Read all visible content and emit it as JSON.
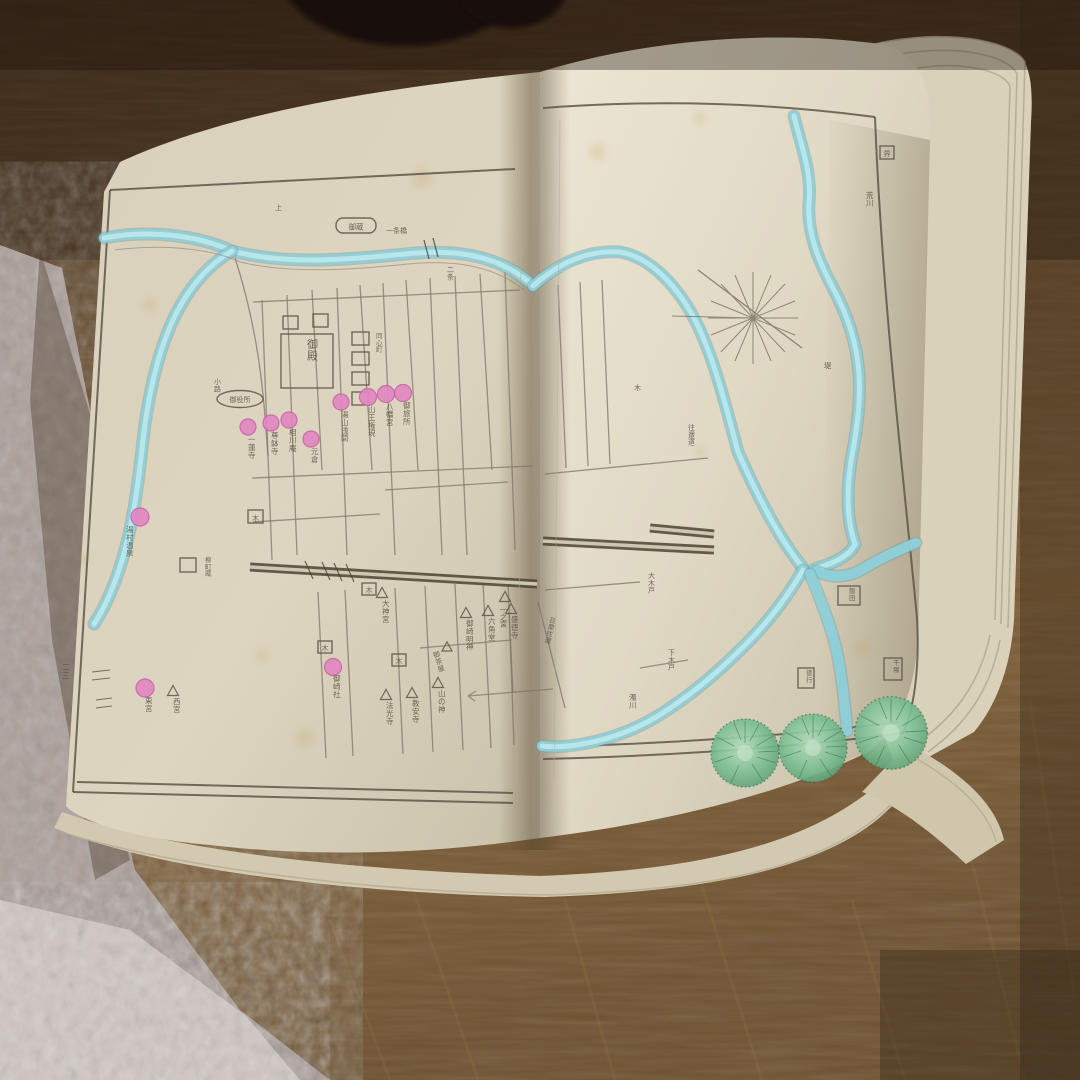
{
  "colors": {
    "wood_dark": "#4a3521",
    "wood_mid": "#6b4e2c",
    "wood_light": "#84633b",
    "carpet": "#b3a7a1",
    "carpet_light": "#d8d0ca",
    "page_cream": "#ded6c0",
    "page_shadow": "#c3bba4",
    "river_blue": "#8fd0d9",
    "marker_pink": "#e387c3",
    "tree_green": "#7cbf92",
    "ink": "#564e3e",
    "black_object": "#16100b"
  },
  "left_page": {
    "palace_label": "御殿",
    "storehouse_cartouche": "御蔵",
    "office_cartouche": "御役所",
    "barracks_label": "同心町",
    "bridge_label": "一条橋",
    "bridge_label_2": "二条",
    "top_margin_char": "上",
    "lane_label": "小路",
    "storehouse_label": "柳町蔵",
    "page_number": "二三",
    "gates": [
      "木",
      "木",
      "木",
      "木"
    ],
    "shrines": [
      {
        "label": "一蓮寺"
      },
      {
        "label": "尊躰寺"
      },
      {
        "label": "相川庵"
      },
      {
        "label": "元倉"
      },
      {
        "label": "湯山浅間"
      },
      {
        "label": "山王権現"
      },
      {
        "label": "八幡宮"
      },
      {
        "label": "御旅所"
      },
      {
        "label": "湯村温泉"
      },
      {
        "label": "東宮"
      },
      {
        "label": "御崎社"
      }
    ],
    "temples": [
      {
        "label": "大神宮"
      },
      {
        "label": "御崎明神"
      },
      {
        "label": "六角堂"
      },
      {
        "label": "盛徳寺"
      },
      {
        "label": "山の神"
      },
      {
        "label": "教安寺"
      },
      {
        "label": "法光寺"
      },
      {
        "label": "西宮"
      },
      {
        "label": "一之宮"
      },
      {
        "label": "御茶屋"
      }
    ]
  },
  "right_page": {
    "river_labels": [
      {
        "label": "荒川"
      },
      {
        "label": "濁川"
      },
      {
        "label": "堤"
      }
    ],
    "village_labels": [
      {
        "label": "飯田"
      },
      {
        "label": "徳行"
      },
      {
        "label": "千塚"
      },
      {
        "label": "界"
      }
    ],
    "road_labels": [
      {
        "label": "往還道"
      },
      {
        "label": "大木戸"
      },
      {
        "label": "下木戸"
      },
      {
        "label": "巨摩往還"
      }
    ],
    "misc_char": "木"
  }
}
